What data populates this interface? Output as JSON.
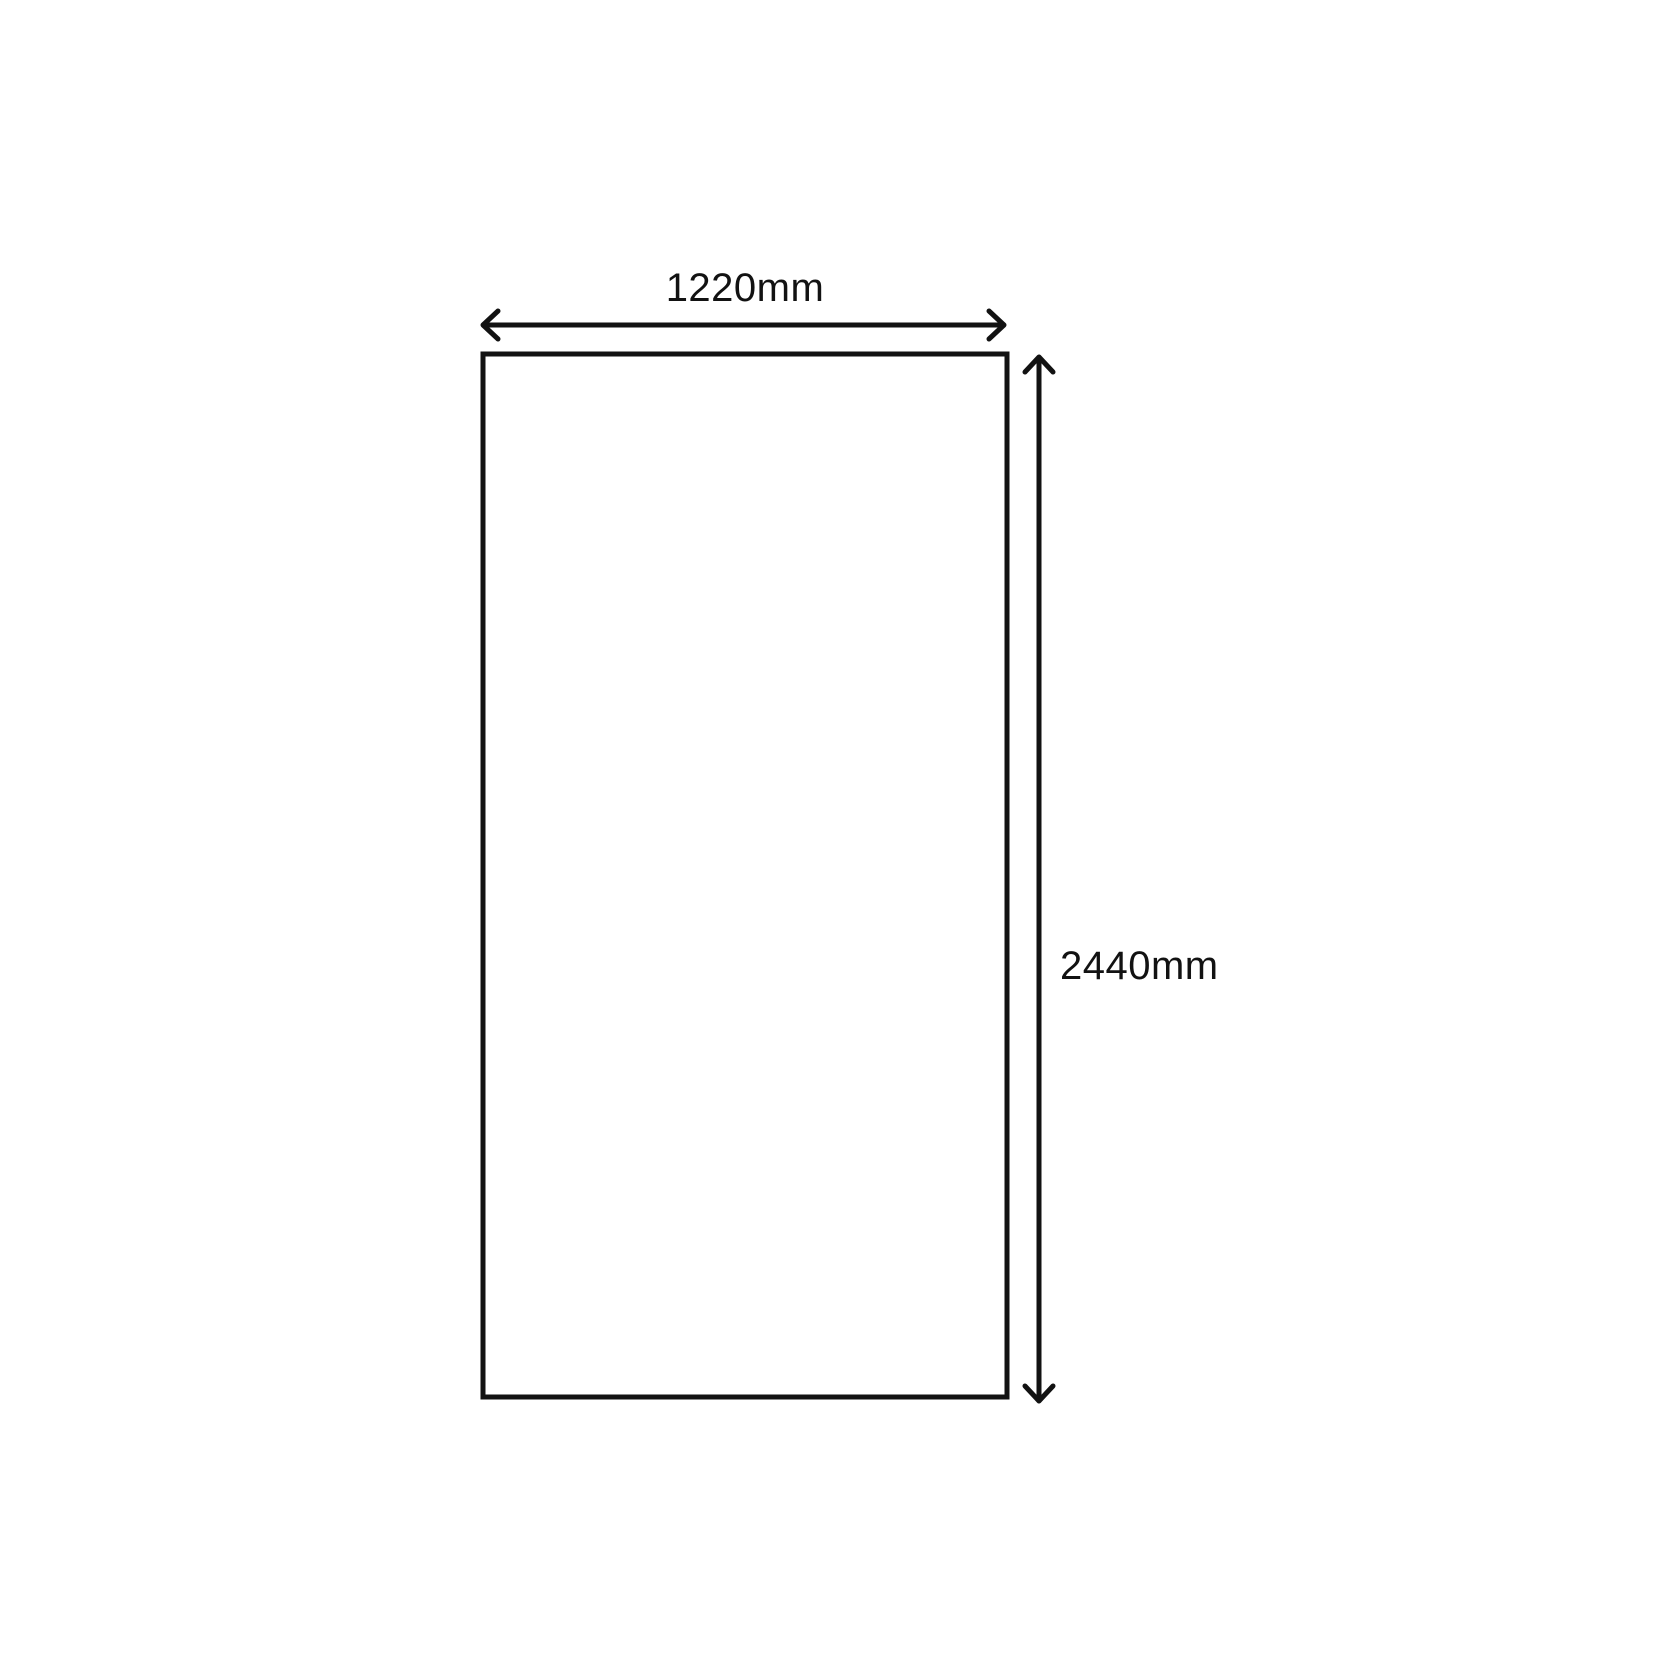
{
  "diagram": {
    "kind": "rectangular sheet dimension drawing",
    "width_label": "1220mm",
    "height_label": "2440mm",
    "width_mm": 1220,
    "height_mm": 2440,
    "line_color": "#121212",
    "background_color": "#ffffff"
  }
}
